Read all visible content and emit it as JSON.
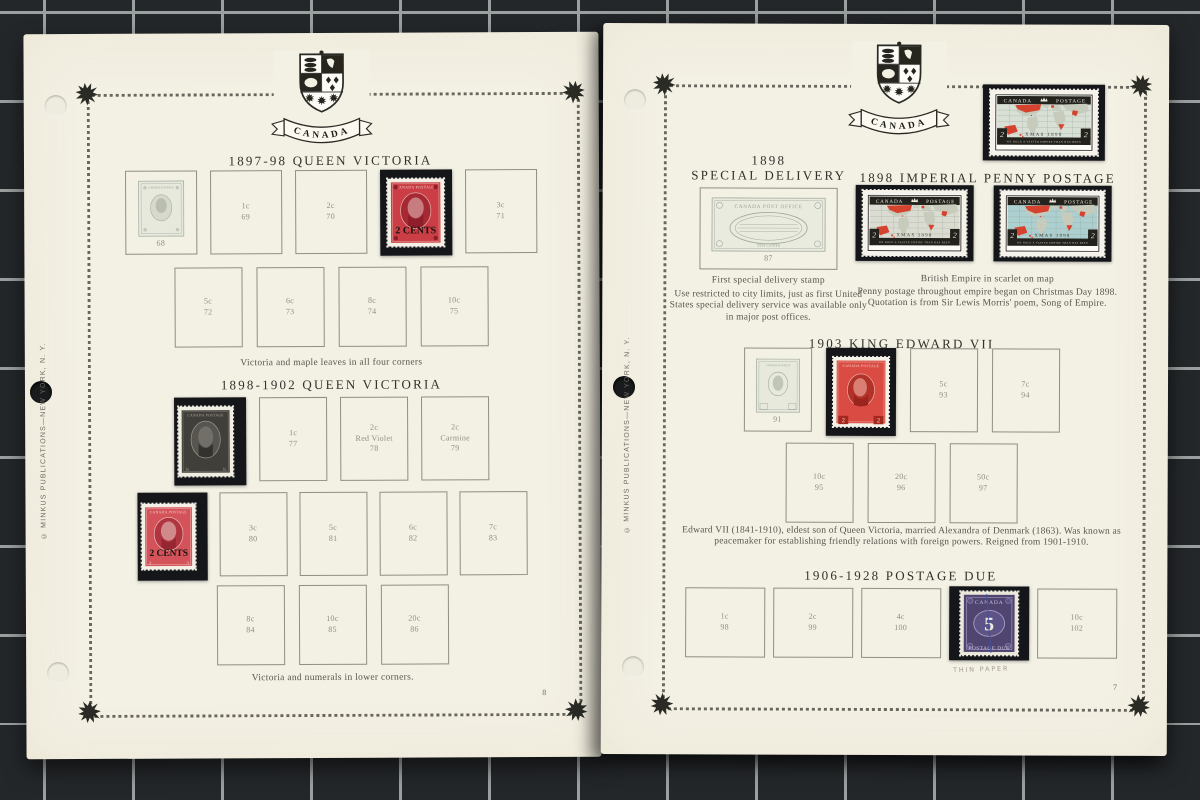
{
  "banner": "CANADA",
  "colors": {
    "page": "#f3f0e4",
    "mount": "#15161a",
    "victoria_red": "#cb3e45",
    "victoria_black": "#413f3a",
    "edward_red": "#d94b43",
    "postage_due_violet": "#4f4570",
    "map_scarlet": "#d5432f",
    "ocean_pale": "#d8e0d6",
    "ocean_gray": "#dbdcd1",
    "ocean_blue": "#accfd0"
  },
  "stamp_text": {
    "map": {
      "left": "CANADA",
      "right": "POSTAGE",
      "xmas": "XMAS 1898",
      "motto": "WE HOLD A VASTER EMPIRE THAN HAS BEEN",
      "value": "2"
    },
    "vic_red": {
      "country": "CANADA POSTAGE",
      "overprint": "2 CENTS",
      "corner": "3"
    },
    "vic_black": {
      "country": "CANADA POSTAGE",
      "half": "½"
    },
    "edward": {
      "country": "CANADA POSTAGE",
      "value": "2"
    },
    "due": {
      "country": "CANADA",
      "value": "5",
      "bottom": "POSTAGE DUE"
    },
    "sd_print": {
      "top": "CANADA POST OFFICE",
      "bottom": "TEN CENTS"
    },
    "printed": {
      "country": "CANADA POSTAGE"
    }
  },
  "left_page": {
    "page_no": "8",
    "copyright": "© MINKUS PUBLICATIONS—NEW YORK, N. Y.",
    "s1": {
      "heading": "1897-98 QUEEN VICTORIA",
      "printed_no": "68",
      "r1": [
        {
          "a": "1c",
          "b": "69"
        },
        {
          "a": "2c",
          "b": "70"
        },
        {
          "a": "3c",
          "b": "71"
        }
      ],
      "r2": [
        {
          "a": "5c",
          "b": "72"
        },
        {
          "a": "6c",
          "b": "73"
        },
        {
          "a": "8c",
          "b": "74"
        },
        {
          "a": "10c",
          "b": "75"
        }
      ],
      "caption": "Victoria and maple leaves in all four corners"
    },
    "s2": {
      "heading": "1898-1902 QUEEN VICTORIA",
      "r1": [
        {
          "a": "1c",
          "b": "77"
        },
        {
          "a": "2c",
          "m": "Red Violet",
          "b": "78"
        },
        {
          "a": "2c",
          "m": "Carmine",
          "b": "79"
        }
      ],
      "r2": [
        {
          "a": "3c",
          "b": "80"
        },
        {
          "a": "5c",
          "b": "81"
        },
        {
          "a": "6c",
          "b": "82"
        },
        {
          "a": "7c",
          "b": "83"
        }
      ],
      "r3": [
        {
          "a": "8c",
          "b": "84"
        },
        {
          "a": "10c",
          "b": "85"
        },
        {
          "a": "20c",
          "b": "86"
        }
      ],
      "caption": "Victoria and numerals in lower corners."
    }
  },
  "right_page": {
    "page_no": "7",
    "copyright": "© MINKUS PUBLICATIONS—NEW YORK, N. Y.",
    "sd": {
      "year": "1898",
      "heading": "SPECIAL DELIVERY",
      "printed_no": "87",
      "caption": "First special delivery stamp",
      "para": "Use restricted to city limits, just as first United States special delivery service was available only in major post offices."
    },
    "ipp": {
      "heading": "1898 IMPERIAL PENNY POSTAGE",
      "caption": "British Empire in scarlet on map",
      "para": "Penny postage throughout empire began on Christmas Day 1898. Quotation is from Sir Lewis Morris' poem, Song of Empire."
    },
    "ed": {
      "heading": "1903 KING EDWARD VII",
      "printed_no": "91",
      "r1": [
        {
          "a": "5c",
          "b": "93"
        },
        {
          "a": "7c",
          "b": "94"
        }
      ],
      "r2": [
        {
          "a": "10c",
          "b": "95"
        },
        {
          "a": "20c",
          "b": "96"
        },
        {
          "a": "50c",
          "b": "97"
        }
      ],
      "para": "Edward VII (1841-1910), eldest son of Queen Victoria, married Alexandra of Denmark (1863). Was known as peacemaker for establishing friendly relations with foreign powers. Reigned from 1901-1910."
    },
    "pd": {
      "heading": "1906-1928 POSTAGE DUE",
      "r1": [
        {
          "a": "1c",
          "b": "98"
        },
        {
          "a": "2c",
          "b": "99"
        },
        {
          "a": "4c",
          "b": "100"
        },
        {
          "a": "10c",
          "b": "102"
        }
      ],
      "note": "THIN PAPER"
    }
  }
}
